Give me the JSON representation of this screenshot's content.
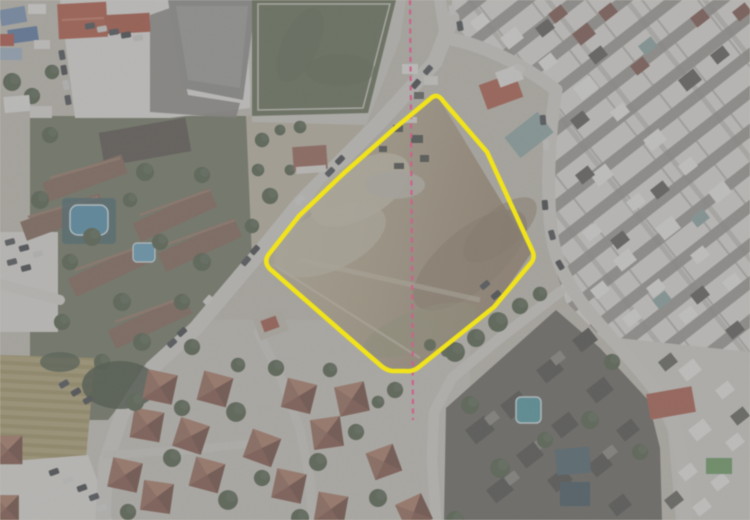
{
  "image": {
    "kind": "aerial-orthophoto-with-parcel-overlay",
    "width_px": 750,
    "height_px": 520
  },
  "overlay": {
    "parcel_boundary": {
      "name": "highlighted-parcel-boundary",
      "color": "#f2e411",
      "stroke_width": 4.5,
      "path": "M 430,99 Q 437,92 443,101 L 487,152 L 532,250 Q 536,258 530,264 L 494,307 L 419,367 Q 413,372 405,371 L 392,371 Q 385,370 379,364 L 341,331 L 270,269 Q 263,262 269,254 L 299,216 L 344,173 L 394,129 Z"
    },
    "survey_centerline": {
      "name": "dashed-survey-line",
      "color": "#d0618d",
      "stroke_width": 2.2,
      "dash_pattern": "5 4.5",
      "path": "M 410,0 L 411,120 L 412,260 L 413,420"
    }
  },
  "scene": {
    "ground_color": "#c9c4b8",
    "sports_field_color": "#5a6647",
    "school_roof_color": "#b94a33",
    "pool_west_color": "#3f8fb5",
    "pool_small_west_color": "#57a3c7",
    "pool_southeast_color": "#3e98a6",
    "parcel_dirt_light": "#cbc1a5",
    "parcel_dirt_dark": "#9a8568",
    "road_color": "#dbd9d3",
    "features": [
      {
        "name": "school-complex-northwest"
      },
      {
        "name": "sports-field-north"
      },
      {
        "name": "dense-urban-blocks-east"
      },
      {
        "name": "vacant-parcel-center"
      },
      {
        "name": "residential-area-west"
      },
      {
        "name": "villa-neighborhood-south"
      },
      {
        "name": "apartment-blocks-southeast"
      },
      {
        "name": "crop-field-southwest"
      },
      {
        "name": "market-stalls-northwest-corner"
      },
      {
        "name": "road-network"
      }
    ]
  }
}
